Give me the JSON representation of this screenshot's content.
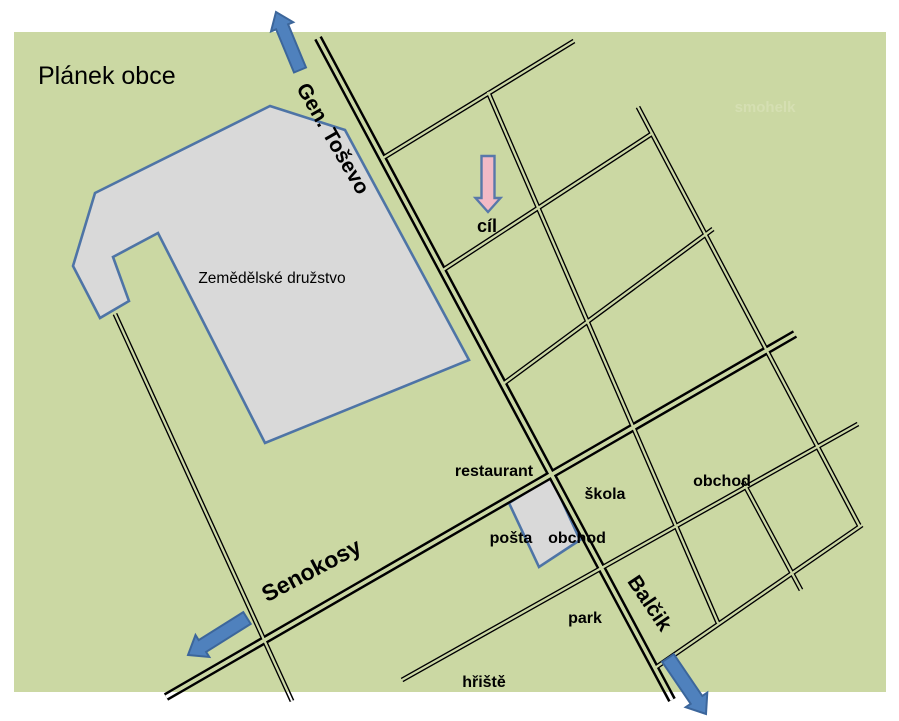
{
  "title": "Plánek obce",
  "watermark": "smohelk",
  "colors": {
    "map_background": "#cbd8a3",
    "road": "#000000",
    "building_fill": "#d9d9d9",
    "building_stroke": "#4e74a6",
    "arrow_blue": "#4f81bd",
    "arrow_pink": "#f2bac6"
  },
  "farm": {
    "label": "Zemědělské družstvo"
  },
  "streets": {
    "gen_tosevo": "Gen. Toševo",
    "senokosy": "Senokosy",
    "balcik": "Balčik"
  },
  "places": {
    "cil": "cíl",
    "restaurant": "restaurant",
    "skola": "škola",
    "obchod_east": "obchod",
    "posta": "pošta",
    "obchod_center": "obchod",
    "park": "park",
    "hriste": "hřiště"
  }
}
